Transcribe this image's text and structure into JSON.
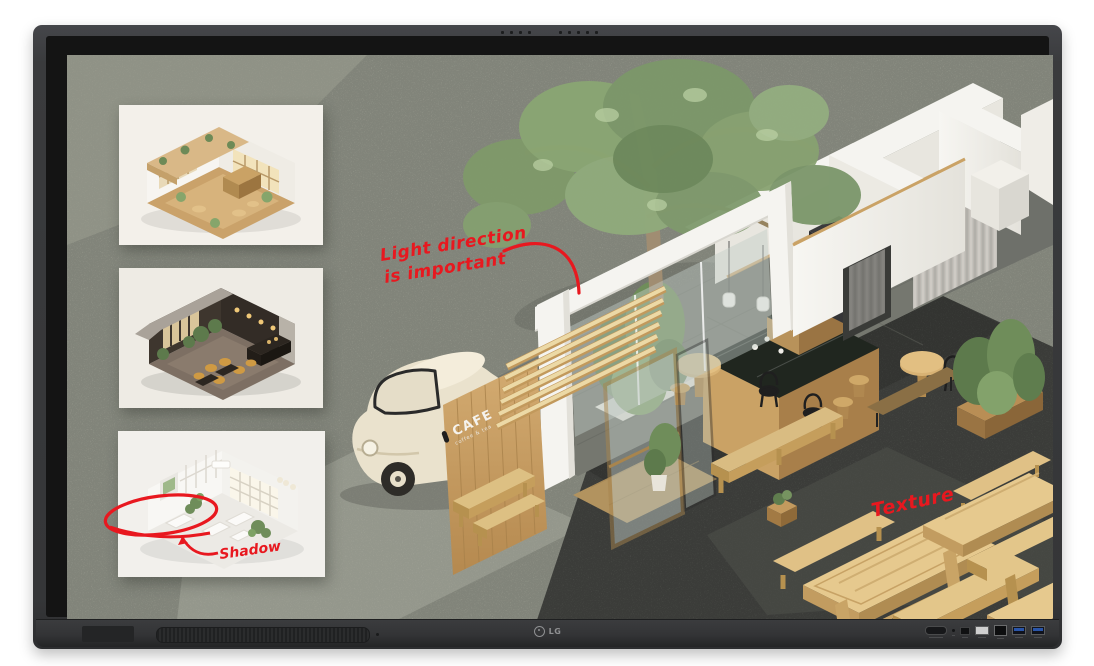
{
  "device": {
    "brand_logo": "LG",
    "mic_dot_count": 9,
    "ports": [
      "power-button",
      "status-led",
      "av-port",
      "usb2-port",
      "touch-usb-port",
      "usb3-port-1",
      "usb3-port-2"
    ]
  },
  "board": {
    "background_color": "#a7aa9d",
    "ink_color": "#e8181f",
    "annotations": {
      "light_direction_line1": "Light direction",
      "light_direction_line2": "is important",
      "shadow_label": "Shadow",
      "texture_label": "Texture"
    },
    "scene": {
      "cafe_sign_title": "CAFE",
      "cafe_sign_subtitle": "coffee & tea"
    },
    "reference_images": [
      {
        "name": "warm-cafe-interior-cutaway"
      },
      {
        "name": "dark-lounge-interior-cutaway"
      },
      {
        "name": "white-minimal-cafe-interior-cutaway"
      }
    ]
  },
  "colors": {
    "bezel": "#3a3b3d",
    "screen_background": "#a7aa9d",
    "annotation_red": "#e8181f",
    "wood": "#c9a266",
    "pavement": "#5b5d58",
    "wall_white": "#f5f4f0",
    "foliage_green": "#7f9a6a",
    "usb3_blue": "#2a55a8"
  }
}
